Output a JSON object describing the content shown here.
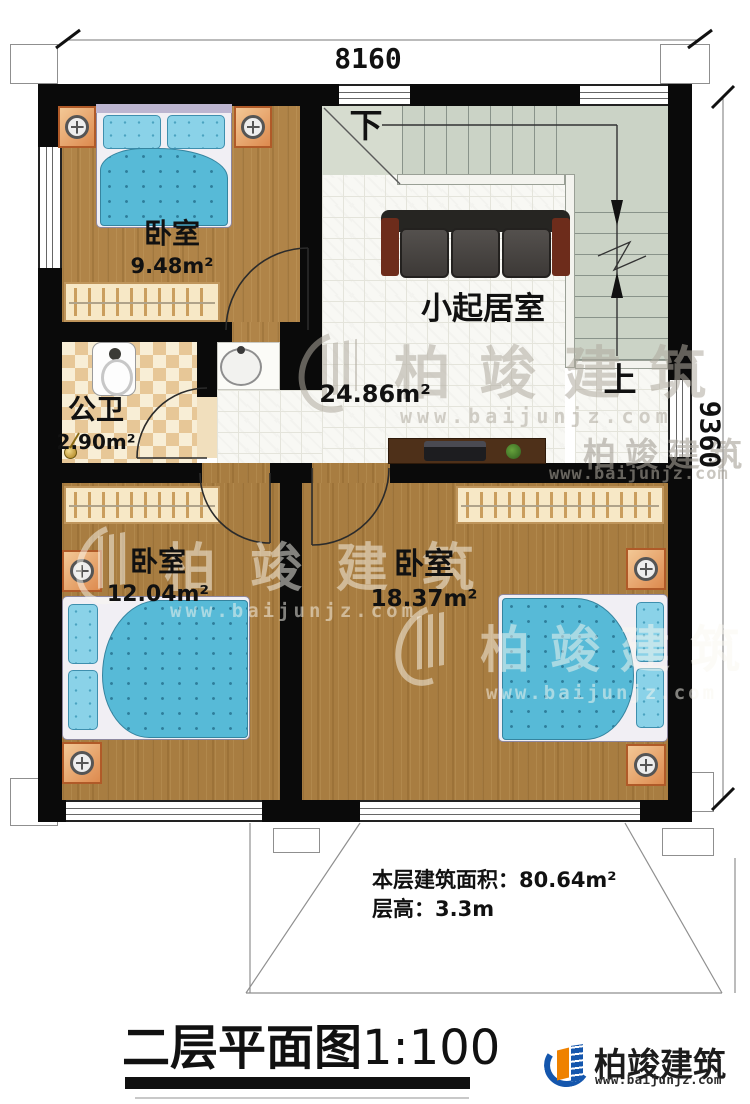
{
  "annotations": {
    "dim_top": "8160",
    "dim_right": "9360"
  },
  "rooms": [
    {
      "name": "卧室",
      "area": "9.48m²"
    },
    {
      "name": "小起居室",
      "area": "24.86m²"
    },
    {
      "name": "公卫",
      "area": "2.90m²"
    },
    {
      "name": "卧室",
      "area": "12.04m²"
    },
    {
      "name": "卧室",
      "area": "18.37m²"
    }
  ],
  "stairs": {
    "down": "下",
    "up": "上"
  },
  "notes": {
    "area_label": "本层建筑面积：",
    "area_value": "80.64m²",
    "height_label": "层高：",
    "height_value": "3.3m"
  },
  "title": {
    "name": "二层平面图",
    "scale": "1:100"
  },
  "brand": {
    "name": "柏竣建筑",
    "site": "www.baijunjz.com"
  },
  "colors": {
    "wall": "#0a0a0a",
    "wood": "#a87d41",
    "stair": "#cbd3c6",
    "bed_blue": "#57bad7",
    "accent_blue": "#1456ad",
    "accent_orange": "#ef8200"
  }
}
